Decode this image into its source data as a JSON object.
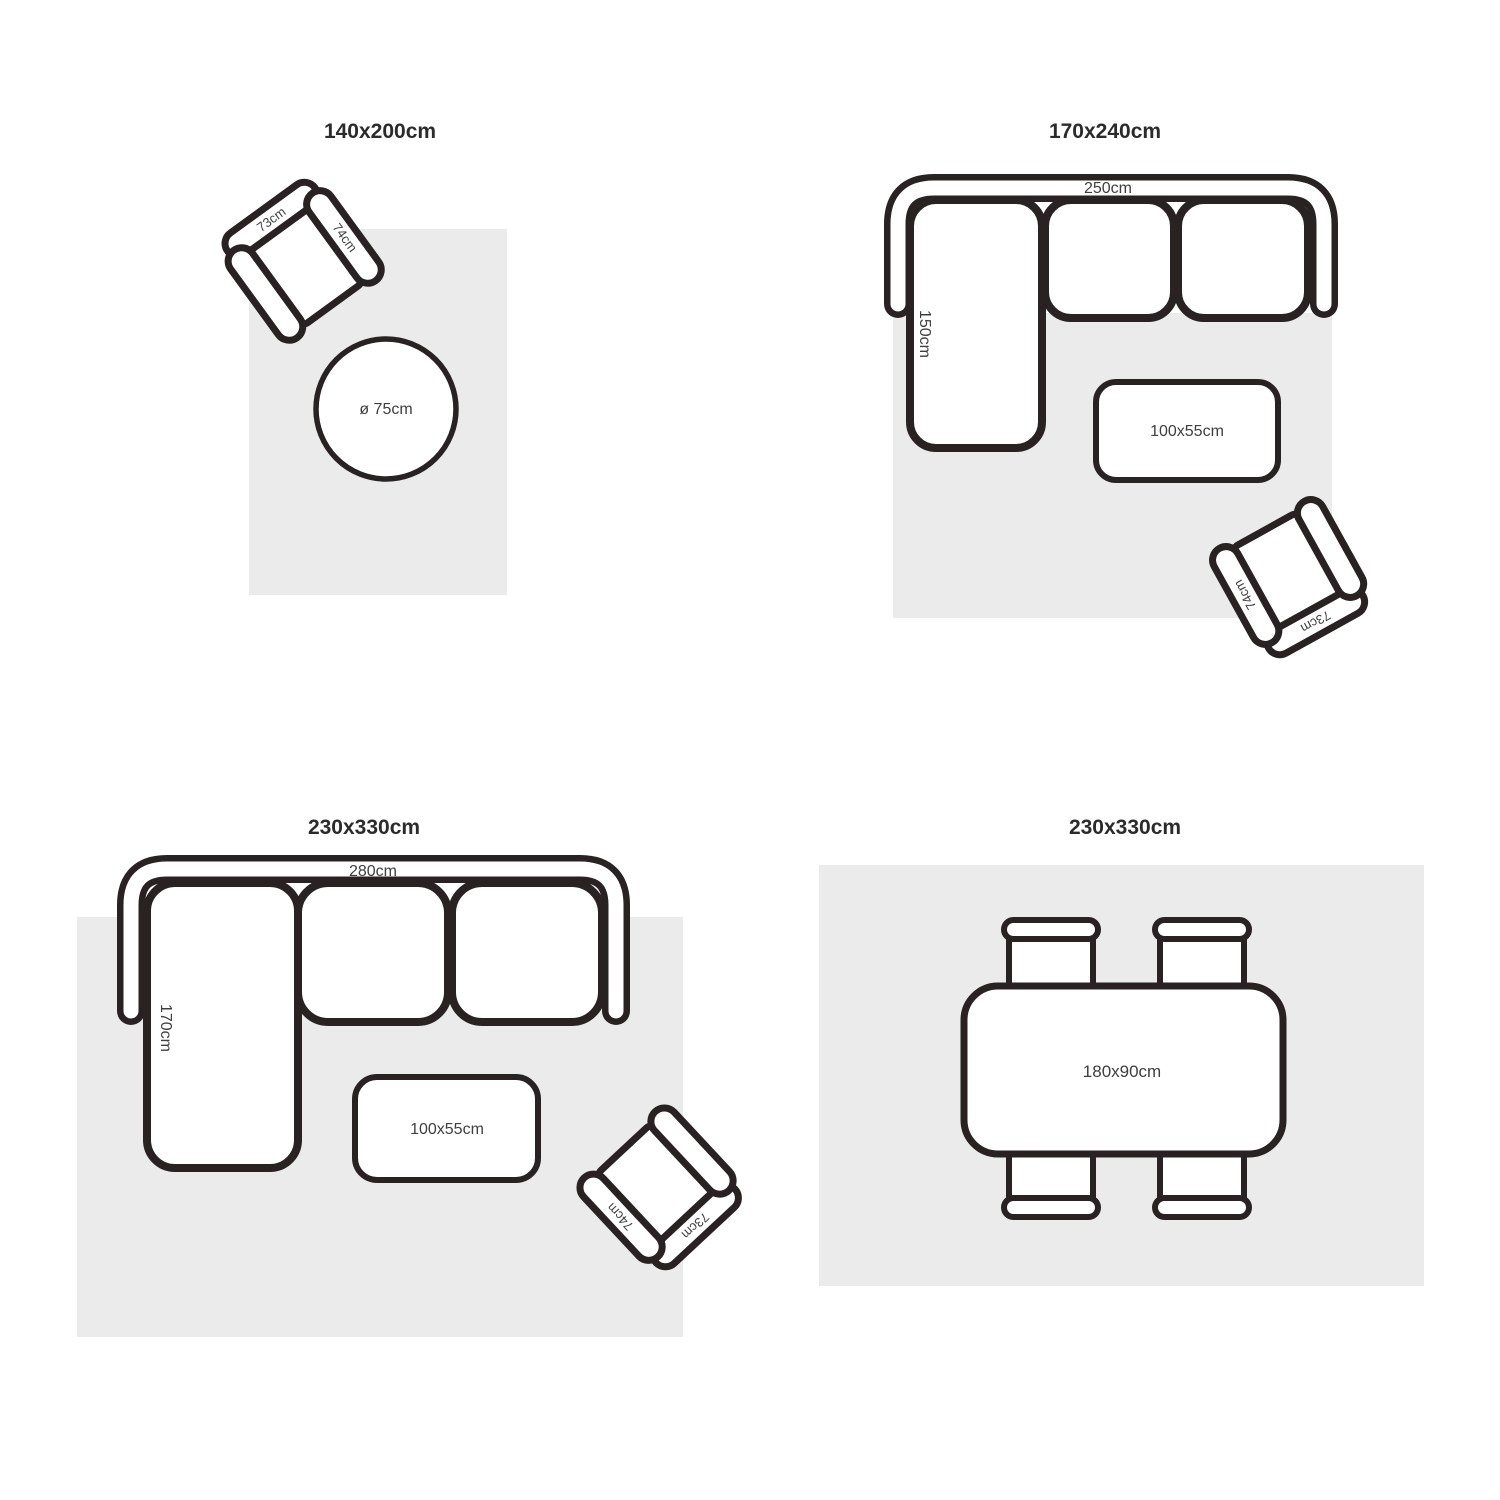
{
  "colors": {
    "outline": "#282223",
    "rug": "#ebebeb",
    "label_text": "#3f3f3f",
    "title_text": "#2b2b2b",
    "background": "#ffffff"
  },
  "quadrants": {
    "tl": {
      "title": "140x200cm",
      "armchair": {
        "back_label": "73cm",
        "arm_label": "74cm"
      },
      "round_table_label": "ø 75cm"
    },
    "tr": {
      "title": "170x240cm",
      "sofa": {
        "width_label": "250cm",
        "chaise_label": "150cm"
      },
      "coffee_table_label": "100x55cm",
      "armchair": {
        "back_label": "73cm",
        "arm_label": "74cm"
      }
    },
    "bl": {
      "title": "230x330cm",
      "sofa": {
        "width_label": "280cm",
        "chaise_label": "170cm"
      },
      "coffee_table_label": "100x55cm",
      "armchair": {
        "back_label": "73cm",
        "arm_label": "74cm"
      }
    },
    "br": {
      "title": "230x330cm",
      "dining_table_label": "180x90cm"
    }
  }
}
